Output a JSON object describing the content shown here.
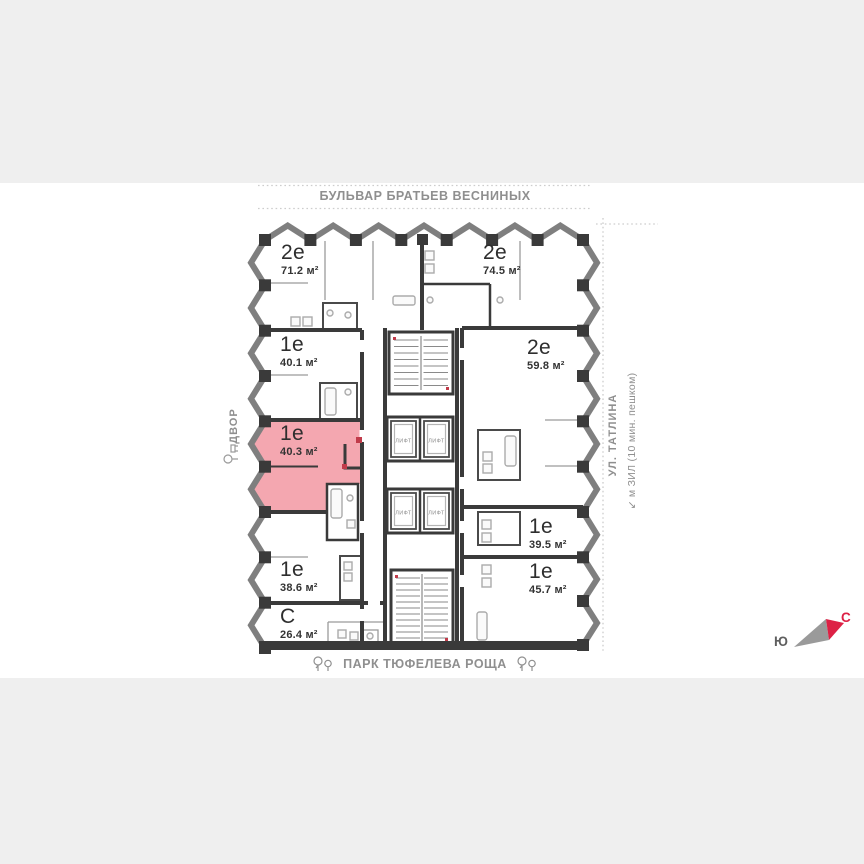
{
  "colors": {
    "page_bg": "#efefef",
    "plan_bg": "#ffffff",
    "walls": "#3a3a3a",
    "highlight_pink": "#f4a7b0",
    "accent_red": "#c13b4a",
    "compass_north_red": "#dd2145",
    "compass_south_gray": "#5f5f5f",
    "street_text_gray": "#8f8f8f"
  },
  "surroundings": {
    "top_street": "БУЛЬВАР БРАТЬЕВ ВЕСНИНЫХ",
    "bottom_park": "ПАРК ТЮФЕЛЕВА РОЩА",
    "courtyard": "ДВОР",
    "right_street": "УЛ. ТАТЛИНА",
    "metro_note": "↙ м ЗИЛ (10 мин. пешком)"
  },
  "compass": {
    "north": "С",
    "south": "Ю"
  },
  "plan": {
    "elevator_label": "ЛИФТ",
    "apartments": [
      {
        "type": "2е",
        "area": "71.2 м²",
        "highlighted": false
      },
      {
        "type": "1е",
        "area": "40.1 м²",
        "highlighted": false
      },
      {
        "type": "1е",
        "area": "40.3 м²",
        "highlighted": true
      },
      {
        "type": "1е",
        "area": "38.6 м²",
        "highlighted": false
      },
      {
        "type": "С",
        "area": "26.4 м²",
        "highlighted": false
      },
      {
        "type": "2е",
        "area": "74.5 м²",
        "highlighted": false
      },
      {
        "type": "2е",
        "area": "59.8 м²",
        "highlighted": false
      },
      {
        "type": "1е",
        "area": "39.5 м²",
        "highlighted": false
      },
      {
        "type": "1е",
        "area": "45.7 м²",
        "highlighted": false
      }
    ]
  }
}
